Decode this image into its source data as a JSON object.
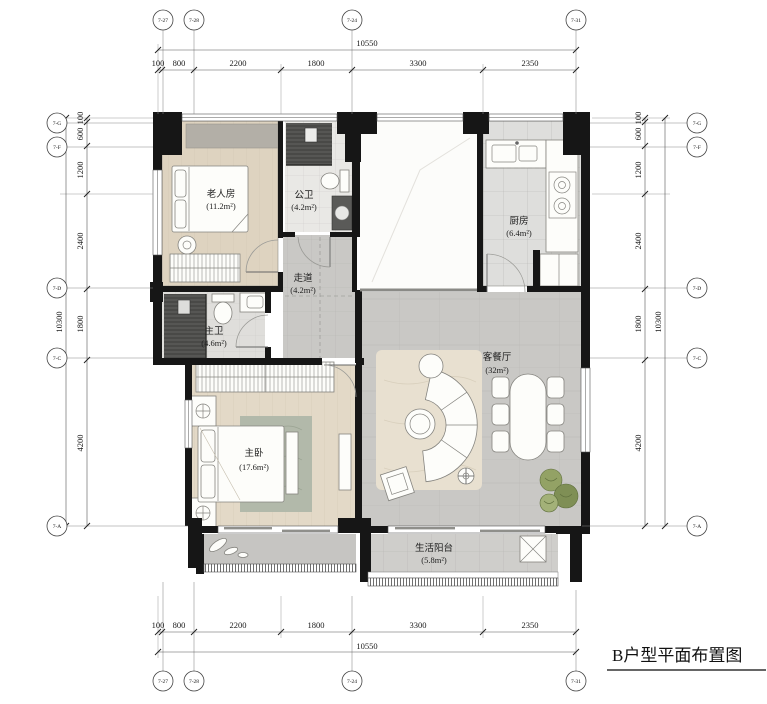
{
  "drawing": {
    "title": "B户型平面布置图"
  },
  "grid": {
    "columns": [
      "7-27",
      "7-28",
      "7-24",
      "7-31"
    ],
    "rows": [
      "7-G",
      "7-F",
      "7-D",
      "7-C",
      "7-A"
    ]
  },
  "dimensions": {
    "horizontal": {
      "total": "10550",
      "segments": [
        "100",
        "800",
        "2200",
        "1800",
        "3300",
        "2350"
      ]
    },
    "vertical": {
      "total": "10300",
      "segments": [
        "100",
        "600",
        "1200",
        "2400",
        "1800",
        "4200"
      ]
    }
  },
  "rooms": {
    "elder_bedroom": {
      "name": "老人房",
      "area": "(11.2m²)"
    },
    "public_bathroom": {
      "name": "公卫",
      "area": "(4.2m²)"
    },
    "kitchen": {
      "name": "厨房",
      "area": "(6.4m²)"
    },
    "corridor": {
      "name": "走道",
      "area": "(4.2m²)"
    },
    "master_bathroom": {
      "name": "主卫",
      "area": "(4.6m²)"
    },
    "master_bedroom": {
      "name": "主卧",
      "area": "(17.6m²)"
    },
    "living_dining": {
      "name": "客餐厅",
      "area": "(32m²)"
    },
    "service_balcony": {
      "name": "生活阳台",
      "area": "(5.8m²)"
    }
  },
  "colors": {
    "wall": "#161616",
    "wood": "#ded3c0",
    "wood2": "#e3d9c7",
    "tile": "#c9c8c5",
    "tileL": "#dededc",
    "bath": "#e9e8e5",
    "stone": "#b3afa7",
    "rugL": "#e8e0d0",
    "rugB": "#b2b9aa",
    "plant": "#93a265",
    "shower": "#565654"
  }
}
